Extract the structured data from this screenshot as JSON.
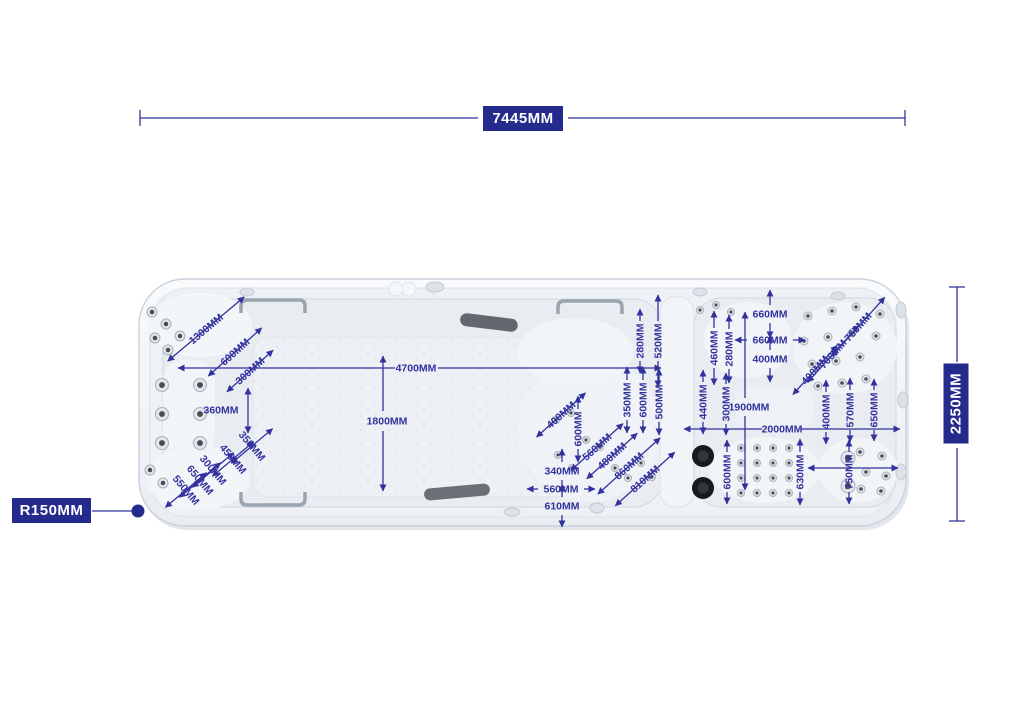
{
  "title": "swim-spa-dimension-diagram",
  "colors": {
    "background": "#ffffff",
    "dimension": "#32329e",
    "label_box_bg": "#252a8d",
    "label_box_text": "#ffffff"
  },
  "primary_dimensions": {
    "overall_length": "7445MM",
    "overall_width": "2250MM",
    "corner_radius": "R150MM"
  },
  "annotations": [
    {
      "text": "1300MM",
      "x": 206,
      "y": 329,
      "rot": -40,
      "arrow": {
        "type": "col",
        "len": 100
      }
    },
    {
      "text": "600MM",
      "x": 235,
      "y": 352,
      "rot": -42,
      "arrow": {
        "type": "col",
        "len": 72
      }
    },
    {
      "text": "300MM",
      "x": 250,
      "y": 371,
      "rot": -42,
      "arrow": {
        "type": "col",
        "len": 62
      }
    },
    {
      "text": "360MM",
      "x": 221,
      "y": 410,
      "rot": 0,
      "arrow": null
    },
    {
      "text": "350MM",
      "x": 252,
      "y": 446,
      "rot": 50,
      "arrow": {
        "type": "perp",
        "len": 54
      }
    },
    {
      "text": "450MM",
      "x": 233,
      "y": 459,
      "rot": 50,
      "arrow": {
        "type": "perp",
        "len": 54
      }
    },
    {
      "text": "300MM",
      "x": 213,
      "y": 470,
      "rot": 50,
      "arrow": {
        "type": "perp",
        "len": 54
      }
    },
    {
      "text": "650MM",
      "x": 200,
      "y": 480,
      "rot": 50,
      "arrow": {
        "type": "perp",
        "len": 54
      }
    },
    {
      "text": "550MM",
      "x": 186,
      "y": 490,
      "rot": 50,
      "arrow": {
        "type": "perp",
        "len": 54
      }
    },
    {
      "text": "4700MM",
      "x": 416,
      "y": 368,
      "rot": 0,
      "arrow": null
    },
    {
      "text": "1800MM",
      "x": 387,
      "y": 421,
      "rot": 0,
      "arrow": null
    },
    {
      "text": "280MM",
      "x": 640,
      "y": 341,
      "rot": -90,
      "arrow": {
        "type": "v",
        "len": 64,
        "gap": 40
      }
    },
    {
      "text": "520MM",
      "x": 658,
      "y": 341,
      "rot": -90,
      "arrow": {
        "type": "v",
        "len": 92,
        "gap": 40
      }
    },
    {
      "text": "350MM",
      "x": 627,
      "y": 400,
      "rot": -90,
      "arrow": {
        "type": "v",
        "len": 66,
        "gap": 40
      }
    },
    {
      "text": "600MM",
      "x": 643,
      "y": 400,
      "rot": -90,
      "arrow": {
        "type": "v",
        "len": 66,
        "gap": 40
      }
    },
    {
      "text": "500MM",
      "x": 659,
      "y": 402,
      "rot": -90,
      "arrow": {
        "type": "v",
        "len": 66,
        "gap": 40
      }
    },
    {
      "text": "400MM",
      "x": 561,
      "y": 415,
      "rot": -42,
      "arrow": {
        "type": "col",
        "len": 66
      }
    },
    {
      "text": "600MM",
      "x": 578,
      "y": 429,
      "rot": -90,
      "arrow": {
        "type": "v",
        "len": 66,
        "gap": 40
      }
    },
    {
      "text": "560MM",
      "x": 597,
      "y": 447,
      "rot": -42,
      "arrow": {
        "type": "col",
        "len": 70
      }
    },
    {
      "text": "480MM",
      "x": 612,
      "y": 456,
      "rot": -42,
      "arrow": {
        "type": "col",
        "len": 68
      }
    },
    {
      "text": "860MM",
      "x": 629,
      "y": 466,
      "rot": -42,
      "arrow": {
        "type": "col",
        "len": 84
      }
    },
    {
      "text": "810MM",
      "x": 645,
      "y": 479,
      "rot": -42,
      "arrow": {
        "type": "col",
        "len": 80
      }
    },
    {
      "text": "340MM",
      "x": 562,
      "y": 471,
      "rot": 0,
      "arrow": {
        "type": "v",
        "len": 44,
        "gap": 18
      }
    },
    {
      "text": "560MM",
      "x": 561,
      "y": 489,
      "rot": 0,
      "arrow": {
        "type": "h",
        "len": 68,
        "gap": 46
      }
    },
    {
      "text": "610MM",
      "x": 562,
      "y": 506,
      "rot": 0,
      "arrow": {
        "type": "v",
        "len": 42,
        "gap": 18
      }
    },
    {
      "text": "660MM",
      "x": 770,
      "y": 314,
      "rot": 0,
      "arrow": {
        "type": "v",
        "len": 48,
        "gap": 18
      }
    },
    {
      "text": "660MM",
      "x": 770,
      "y": 340,
      "rot": 0,
      "arrow": {
        "type": "h",
        "len": 70,
        "gap": 46
      }
    },
    {
      "text": "400MM",
      "x": 770,
      "y": 359,
      "rot": 0,
      "arrow": {
        "type": "v",
        "len": 46,
        "gap": 18
      }
    },
    {
      "text": "460MM",
      "x": 714,
      "y": 348,
      "rot": -90,
      "arrow": {
        "type": "v",
        "len": 74,
        "gap": 40
      }
    },
    {
      "text": "280MM",
      "x": 729,
      "y": 349,
      "rot": -90,
      "arrow": {
        "type": "v",
        "len": 68,
        "gap": 40
      }
    },
    {
      "text": "760MM",
      "x": 858,
      "y": 327,
      "rot": -48,
      "arrow": {
        "type": "col",
        "len": 80
      }
    },
    {
      "text": "700MM",
      "x": 833,
      "y": 354,
      "rot": -48,
      "arrow": {
        "type": "col",
        "len": 76
      }
    },
    {
      "text": "400MM",
      "x": 815,
      "y": 370,
      "rot": -48,
      "arrow": {
        "type": "col",
        "len": 66
      }
    },
    {
      "text": "440MM",
      "x": 703,
      "y": 402,
      "rot": -90,
      "arrow": {
        "type": "v",
        "len": 64,
        "gap": 40
      }
    },
    {
      "text": "300MM",
      "x": 726,
      "y": 404,
      "rot": -90,
      "arrow": {
        "type": "v",
        "len": 62,
        "gap": 40
      }
    },
    {
      "text": "1900MM",
      "x": 749,
      "y": 407,
      "rot": 0,
      "arrow": null
    },
    {
      "text": "2000MM",
      "x": 782,
      "y": 429,
      "rot": 0,
      "arrow": null
    },
    {
      "text": "400MM",
      "x": 826,
      "y": 412,
      "rot": -90,
      "arrow": {
        "type": "v",
        "len": 64,
        "gap": 40
      }
    },
    {
      "text": "570MM",
      "x": 850,
      "y": 410,
      "rot": -90,
      "arrow": {
        "type": "v",
        "len": 64,
        "gap": 40
      }
    },
    {
      "text": "650MM",
      "x": 874,
      "y": 410,
      "rot": -90,
      "arrow": {
        "type": "v",
        "len": 62,
        "gap": 40
      }
    },
    {
      "text": "600MM",
      "x": 727,
      "y": 472,
      "rot": -90,
      "arrow": {
        "type": "v",
        "len": 64,
        "gap": 40
      }
    },
    {
      "text": "630MM",
      "x": 800,
      "y": 472,
      "rot": -90,
      "arrow": {
        "type": "v",
        "len": 66,
        "gap": 40
      }
    },
    {
      "text": "750MM",
      "x": 849,
      "y": 472,
      "rot": -90,
      "arrow": {
        "type": "v",
        "len": 64,
        "gap": 40
      }
    }
  ],
  "dim_lines": [
    {
      "x1": 140,
      "y1": 118,
      "x2": 478,
      "y2": 118,
      "heads": "none"
    },
    {
      "x1": 568,
      "y1": 118,
      "x2": 905,
      "y2": 118,
      "heads": "none"
    },
    {
      "x1": 140,
      "y1": 110,
      "x2": 140,
      "y2": 126,
      "heads": "none"
    },
    {
      "x1": 905,
      "y1": 110,
      "x2": 905,
      "y2": 126,
      "heads": "none"
    },
    {
      "x1": 957,
      "y1": 287,
      "x2": 957,
      "y2": 362,
      "heads": "none"
    },
    {
      "x1": 957,
      "y1": 448,
      "x2": 957,
      "y2": 521,
      "heads": "none"
    },
    {
      "x1": 949,
      "y1": 287,
      "x2": 965,
      "y2": 287,
      "heads": "none"
    },
    {
      "x1": 949,
      "y1": 521,
      "x2": 965,
      "y2": 521,
      "heads": "none"
    },
    {
      "x1": 92,
      "y1": 511,
      "x2": 136,
      "y2": 511,
      "heads": "none"
    },
    {
      "x1": 178,
      "y1": 368,
      "x2": 395,
      "y2": 368,
      "heads": "start"
    },
    {
      "x1": 438,
      "y1": 368,
      "x2": 661,
      "y2": 368,
      "heads": "end"
    },
    {
      "x1": 383,
      "y1": 356,
      "x2": 383,
      "y2": 411,
      "heads": "start"
    },
    {
      "x1": 383,
      "y1": 431,
      "x2": 383,
      "y2": 491,
      "heads": "end"
    },
    {
      "x1": 745,
      "y1": 312,
      "x2": 745,
      "y2": 398,
      "heads": "start"
    },
    {
      "x1": 745,
      "y1": 416,
      "x2": 745,
      "y2": 490,
      "heads": "end"
    },
    {
      "x1": 684,
      "y1": 429,
      "x2": 762,
      "y2": 429,
      "heads": "start"
    },
    {
      "x1": 801,
      "y1": 429,
      "x2": 900,
      "y2": 429,
      "heads": "end"
    },
    {
      "x1": 248,
      "y1": 388,
      "x2": 248,
      "y2": 433,
      "heads": "both"
    },
    {
      "x1": 808,
      "y1": 468,
      "x2": 898,
      "y2": 468,
      "heads": "both"
    }
  ],
  "dots": [
    {
      "x": 138,
      "y": 511,
      "r": 6.5
    }
  ]
}
